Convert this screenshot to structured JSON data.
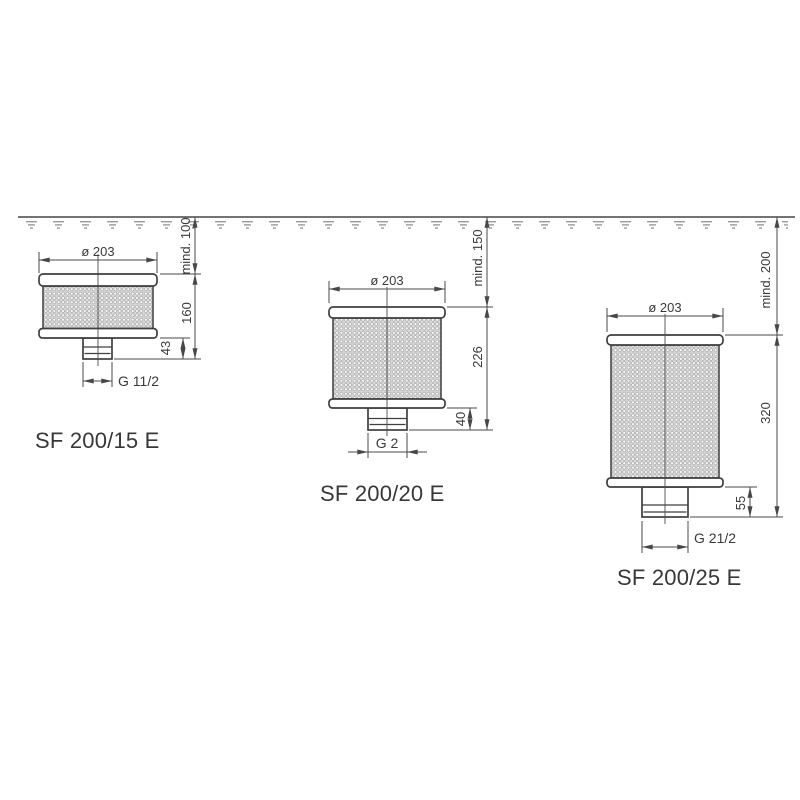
{
  "filters": [
    {
      "label": "SF 200/15 E",
      "diameter": "ø 203",
      "min_submersion": "mind. 100",
      "body_height": "160",
      "outlet_height": "43",
      "thread": "G 11/2"
    },
    {
      "label": "SF 200/20 E",
      "diameter": "ø 203",
      "min_submersion": "mind. 150",
      "body_height": "226",
      "outlet_height": "40",
      "thread": "G 2"
    },
    {
      "label": "SF 200/25 E",
      "diameter": "ø 203",
      "min_submersion": "mind. 200",
      "body_height": "320",
      "outlet_height": "55",
      "thread": "G 21/2"
    }
  ]
}
